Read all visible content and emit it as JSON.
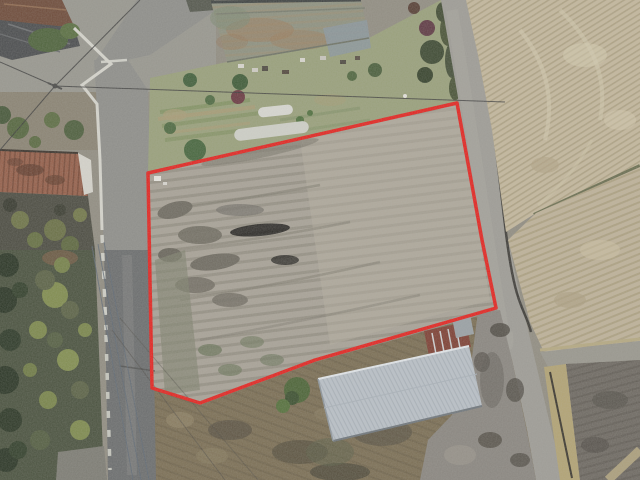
{
  "meta": {
    "type": "aerial-drone-photograph",
    "description": "Top-down drone photo of a rural land plot outlined in red, bordered by an L-shaped road network, harvested rice fields, farm buildings and trees",
    "width": 640,
    "height": 480
  },
  "boundary": {
    "name": "land-plot-outline",
    "color": "#e42420",
    "stroke_width": "3.5",
    "points": "148,173 457,103 482,240 496,308 315,360 200,403 152,388"
  },
  "palette": {
    "base": "#918d82",
    "paved_top": "#98978f",
    "left_road_upper": "#8e8e8a",
    "left_road_lower": "#6b6d6e",
    "right_road": "#9e9c96",
    "plot_field": "#a8a297",
    "field_top_right": "#c4b89d",
    "field_mid_right": "#beb299",
    "soil_dark": "#6e6962",
    "straw_strip": "#b2a374",
    "dry_grass": "#7b6e54",
    "garden": "#99a07b",
    "trees_dark": "#4a523f",
    "metal_roof": "#bac1c8",
    "rust_roof": "#955f4a",
    "rust_annex": "#7e4034",
    "big_roof": "#8e9180",
    "house_roof": "#4b4d4f",
    "house_roof_brown": "#6e4b3a",
    "wall_white": "#d6d5cd",
    "gravel": "#8a8680",
    "hedge_divider": "#6a6e50",
    "branch_road": "#99978e"
  },
  "features": {
    "plot": "plowed land plot outlined in red",
    "left_road": "asphalt road running north-south on the left",
    "right_road": "gray farm road running north-south on the right",
    "big_building": "large corrugated-roof barn at top center",
    "metal_building": "silver corrugated-roof shed at bottom right of plot",
    "rust_building": "rusty-roofed shed at left edge",
    "house": "tile-roofed house at top-left corner",
    "garden": "garden strip with bushes and white row covers",
    "fields": "harvested striped paddies on the right",
    "trees": "dark tree belt along lower left",
    "power_lines": "overhead utility wires crossing the scene"
  }
}
